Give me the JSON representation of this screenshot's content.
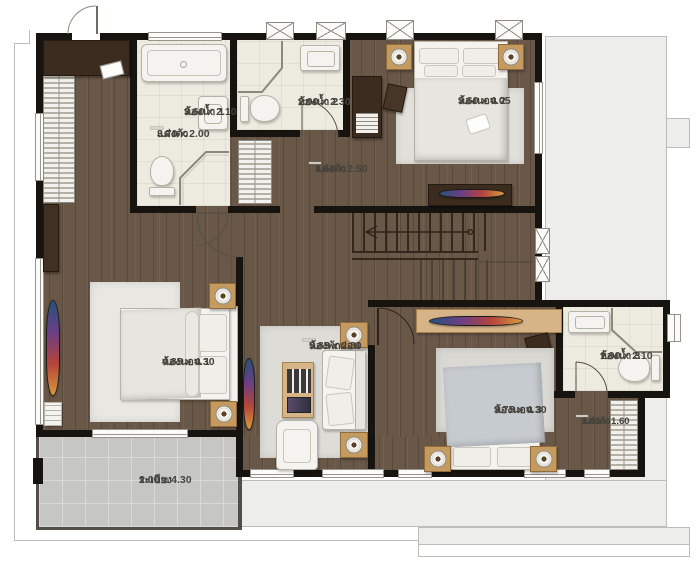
{
  "plan": {
    "type": "floor-plan",
    "floor_material_color": "#695747",
    "wall_color": "#17140f",
    "bath_tile_color": "#edeadf",
    "balcony_tile_color": "#c6c7c4",
    "roof_color": "#ededeb",
    "accent_tv_colors": [
      "#26527c",
      "#6b3f85",
      "#b5443b",
      "#d79a3d"
    ]
  },
  "rooms": [
    {
      "id": "dressing-1",
      "name": "แต่งตัว",
      "dims": "3.70 x 2.00"
    },
    {
      "id": "bath-1",
      "name": "ห้องน้ำ 1",
      "dims": "3.60 x 2.10"
    },
    {
      "id": "bath-2",
      "name": "ห้องน้ำ 2",
      "dims": "2.00 x 2.30"
    },
    {
      "id": "bedroom-2",
      "name": "ห้องนอน 2",
      "dims": "3.60 x 4.05"
    },
    {
      "id": "dressing-2",
      "name": "แต่งตัว",
      "dims": "1.50 x 2.50"
    },
    {
      "id": "bedroom-1",
      "name": "ห้องนอน 1",
      "dims": "4.85 x 4.30"
    },
    {
      "id": "family",
      "name": "ห้องพักผ่อน",
      "dims": "5.85 x 2.80"
    },
    {
      "id": "bedroom-3",
      "name": "ห้องนอน 3",
      "dims": "3.75 x 4.30"
    },
    {
      "id": "bath-3",
      "name": "ห้องน้ำ 3",
      "dims": "1.90 x 2.10"
    },
    {
      "id": "dressing-3",
      "name": "แต่งตัว",
      "dims": "1.65 x 1.60"
    },
    {
      "id": "balcony",
      "name": "ระเบียง",
      "dims": "2.00 x 4.30"
    }
  ]
}
